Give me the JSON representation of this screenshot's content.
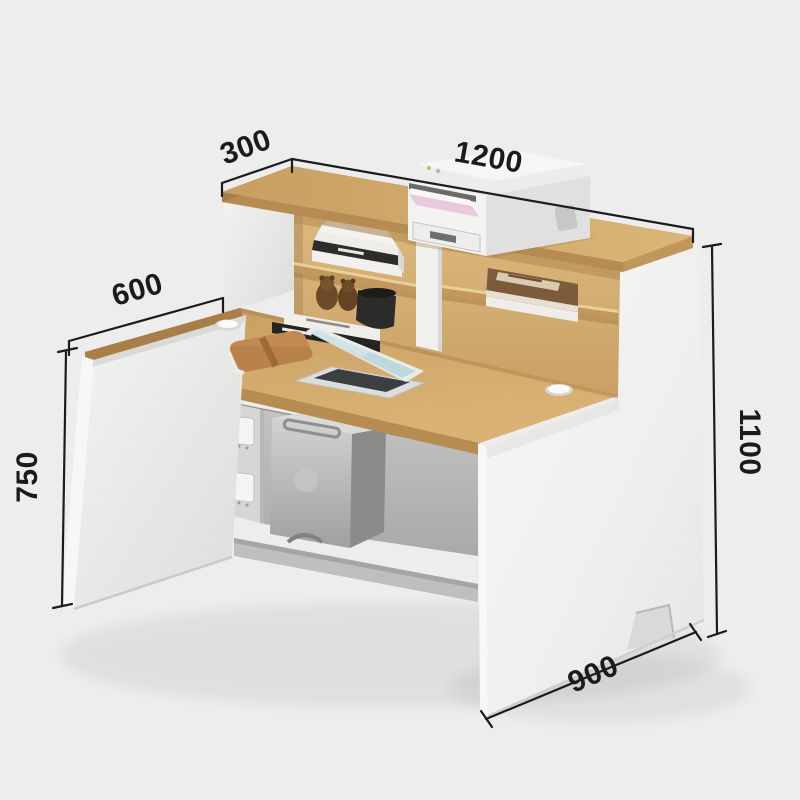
{
  "page": {
    "type": "product-photo",
    "subject": "Office reception desk with hutch shelves, annotated with millimeter dimensions",
    "background": "#ededed"
  },
  "dimensions": {
    "hutch_depth": "300",
    "overall_width": "1200",
    "desktop_depth": "600",
    "desktop_height": "750",
    "overall_height": "1100",
    "side_cabinet_depth": "900"
  },
  "objects": {
    "printer": "laser printer with pink paper in output tray",
    "books_upper_shelf": "stack of books on left hutch shelf",
    "book_right_shelf": "brown hardcover book on right hutch shelf",
    "books_lower": "stack of books with black spine inside left compartment",
    "teddy_bears": "two small bear figurines",
    "storage_pot": "black round container",
    "laptop": "open laptop on desktop",
    "organizer": "tan leather notebook organizer",
    "pc_tower": "gray computer tower under desk",
    "power_outlets": "two wall sockets on inner pillar",
    "cable_grommets": "two white cable grommets in desktop"
  },
  "colors": {
    "background": "#ededed",
    "wood_top": "#d2a96c",
    "wood_edge": "#b68c52",
    "panel_white": "#f2f2f0",
    "under_desk_gray": "#b5b5b3",
    "annotation_line": "#1c1c1c",
    "paper_pink": "#e9cfdf",
    "leather_tan": "#c08a52",
    "laptop_screen": "#bdd9dc"
  }
}
